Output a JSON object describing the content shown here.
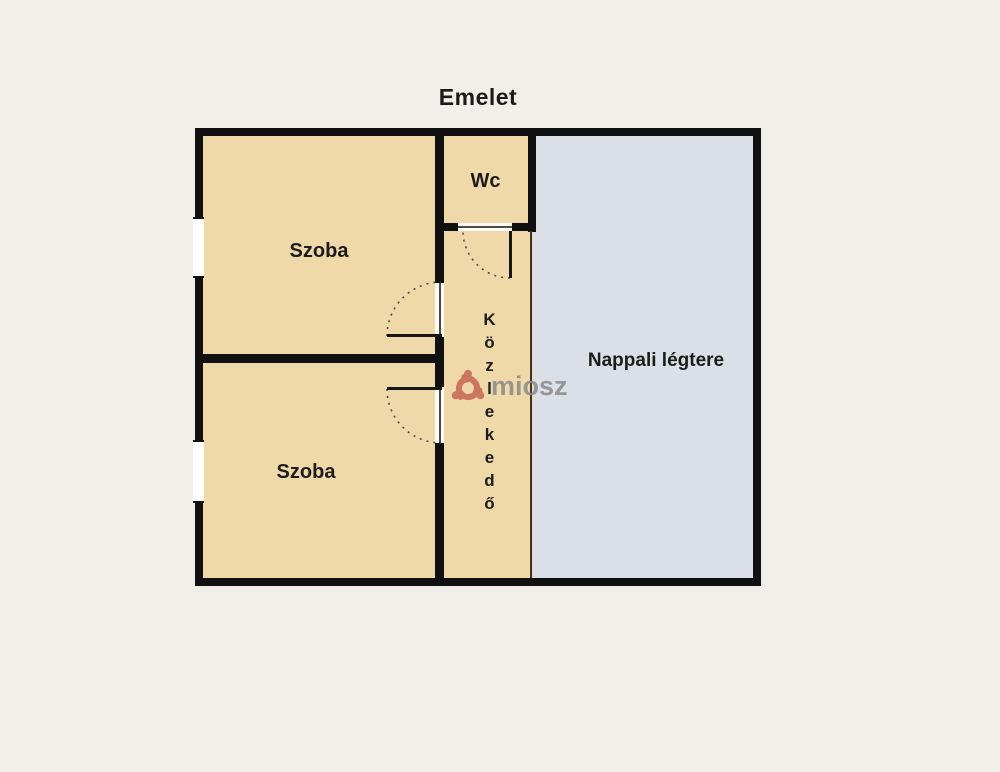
{
  "title": "Emelet",
  "rooms": {
    "szoba_top": {
      "label": "Szoba"
    },
    "szoba_bottom": {
      "label": "Szoba"
    },
    "wc": {
      "label": "Wc"
    },
    "kozlekedo": {
      "label": "Közlekedő"
    },
    "nappali": {
      "label": "Nappali légtere"
    }
  },
  "watermark": {
    "text": "miosz",
    "logo": "miosz-people-swirl-logo"
  },
  "colors": {
    "background": "#f0efea",
    "room_beige": "#f0d9a9",
    "room_blue": "#dbdfe8",
    "wall": "#101010",
    "watermark_logo": "#c4624e",
    "watermark_text": "#8a8a8a"
  }
}
